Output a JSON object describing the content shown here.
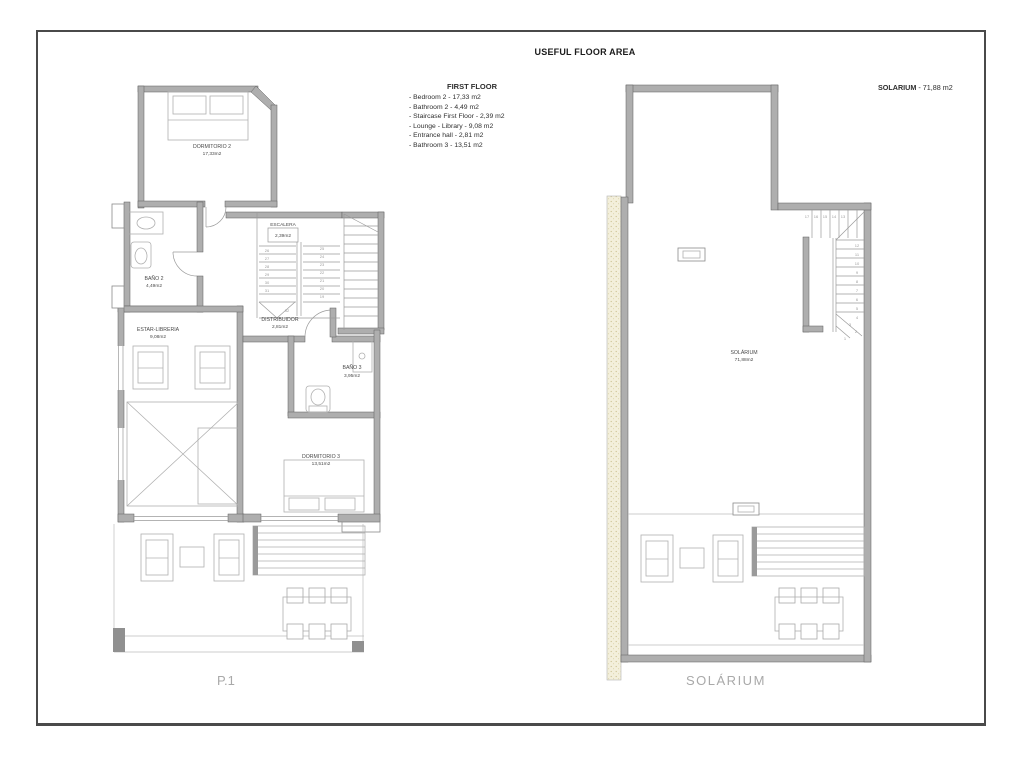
{
  "sheet": {
    "title": "USEFUL FLOOR AREA"
  },
  "legend": {
    "title": "FIRST FLOOR",
    "items": [
      "- Bedroom 2 - 17,33 m2",
      "- Bathroom 2 - 4,49 m2",
      "- Staircase First Floor - 2,39 m2",
      "- Lounge - Library - 9,08 m2",
      "- Entrance hall - 2,81 m2",
      "- Bathroom 3 - 13,51 m2"
    ]
  },
  "solarium_header": {
    "name": "SOLARIUM",
    "rest": " - 71,88 m2"
  },
  "p1": {
    "caption": "P.1",
    "rooms": {
      "dormitorio2": {
        "name": "DORMITORIO 2",
        "area": "17,33m2"
      },
      "bano2": {
        "name": "BAÑO 2",
        "area": "4,49m2"
      },
      "escalera": {
        "name": "ESCALERA",
        "area": "2,39m2"
      },
      "estar_libreria": {
        "name": "ESTAR-LIBRERIA",
        "area": "9,08m2"
      },
      "distribuidor": {
        "name": "DISTRIBUIDOR",
        "area": "2,81m2"
      },
      "bano3": {
        "name": "BAÑO 3",
        "area": "3,95m2"
      },
      "dormitorio3": {
        "name": "DORMITORIO 3",
        "area": "13,51m2"
      }
    },
    "stairs": {
      "left_numbers": [
        "26",
        "27",
        "28",
        "29",
        "30",
        "31"
      ],
      "right_numbers": [
        "25",
        "24",
        "23",
        "22",
        "21",
        "20",
        "19"
      ],
      "landing": "32"
    }
  },
  "solarium": {
    "caption": "SOLÁRIUM",
    "room": {
      "name": "SOLÁRIUM",
      "area": "71,88m2"
    },
    "stairs": {
      "top_numbers": [
        "17",
        "16",
        "15",
        "14",
        "13"
      ],
      "side_numbers": [
        "12",
        "11",
        "10",
        "9",
        "8",
        "7",
        "6",
        "5",
        "4",
        "3"
      ],
      "bottom_numbers": [
        "2",
        "1"
      ]
    }
  }
}
